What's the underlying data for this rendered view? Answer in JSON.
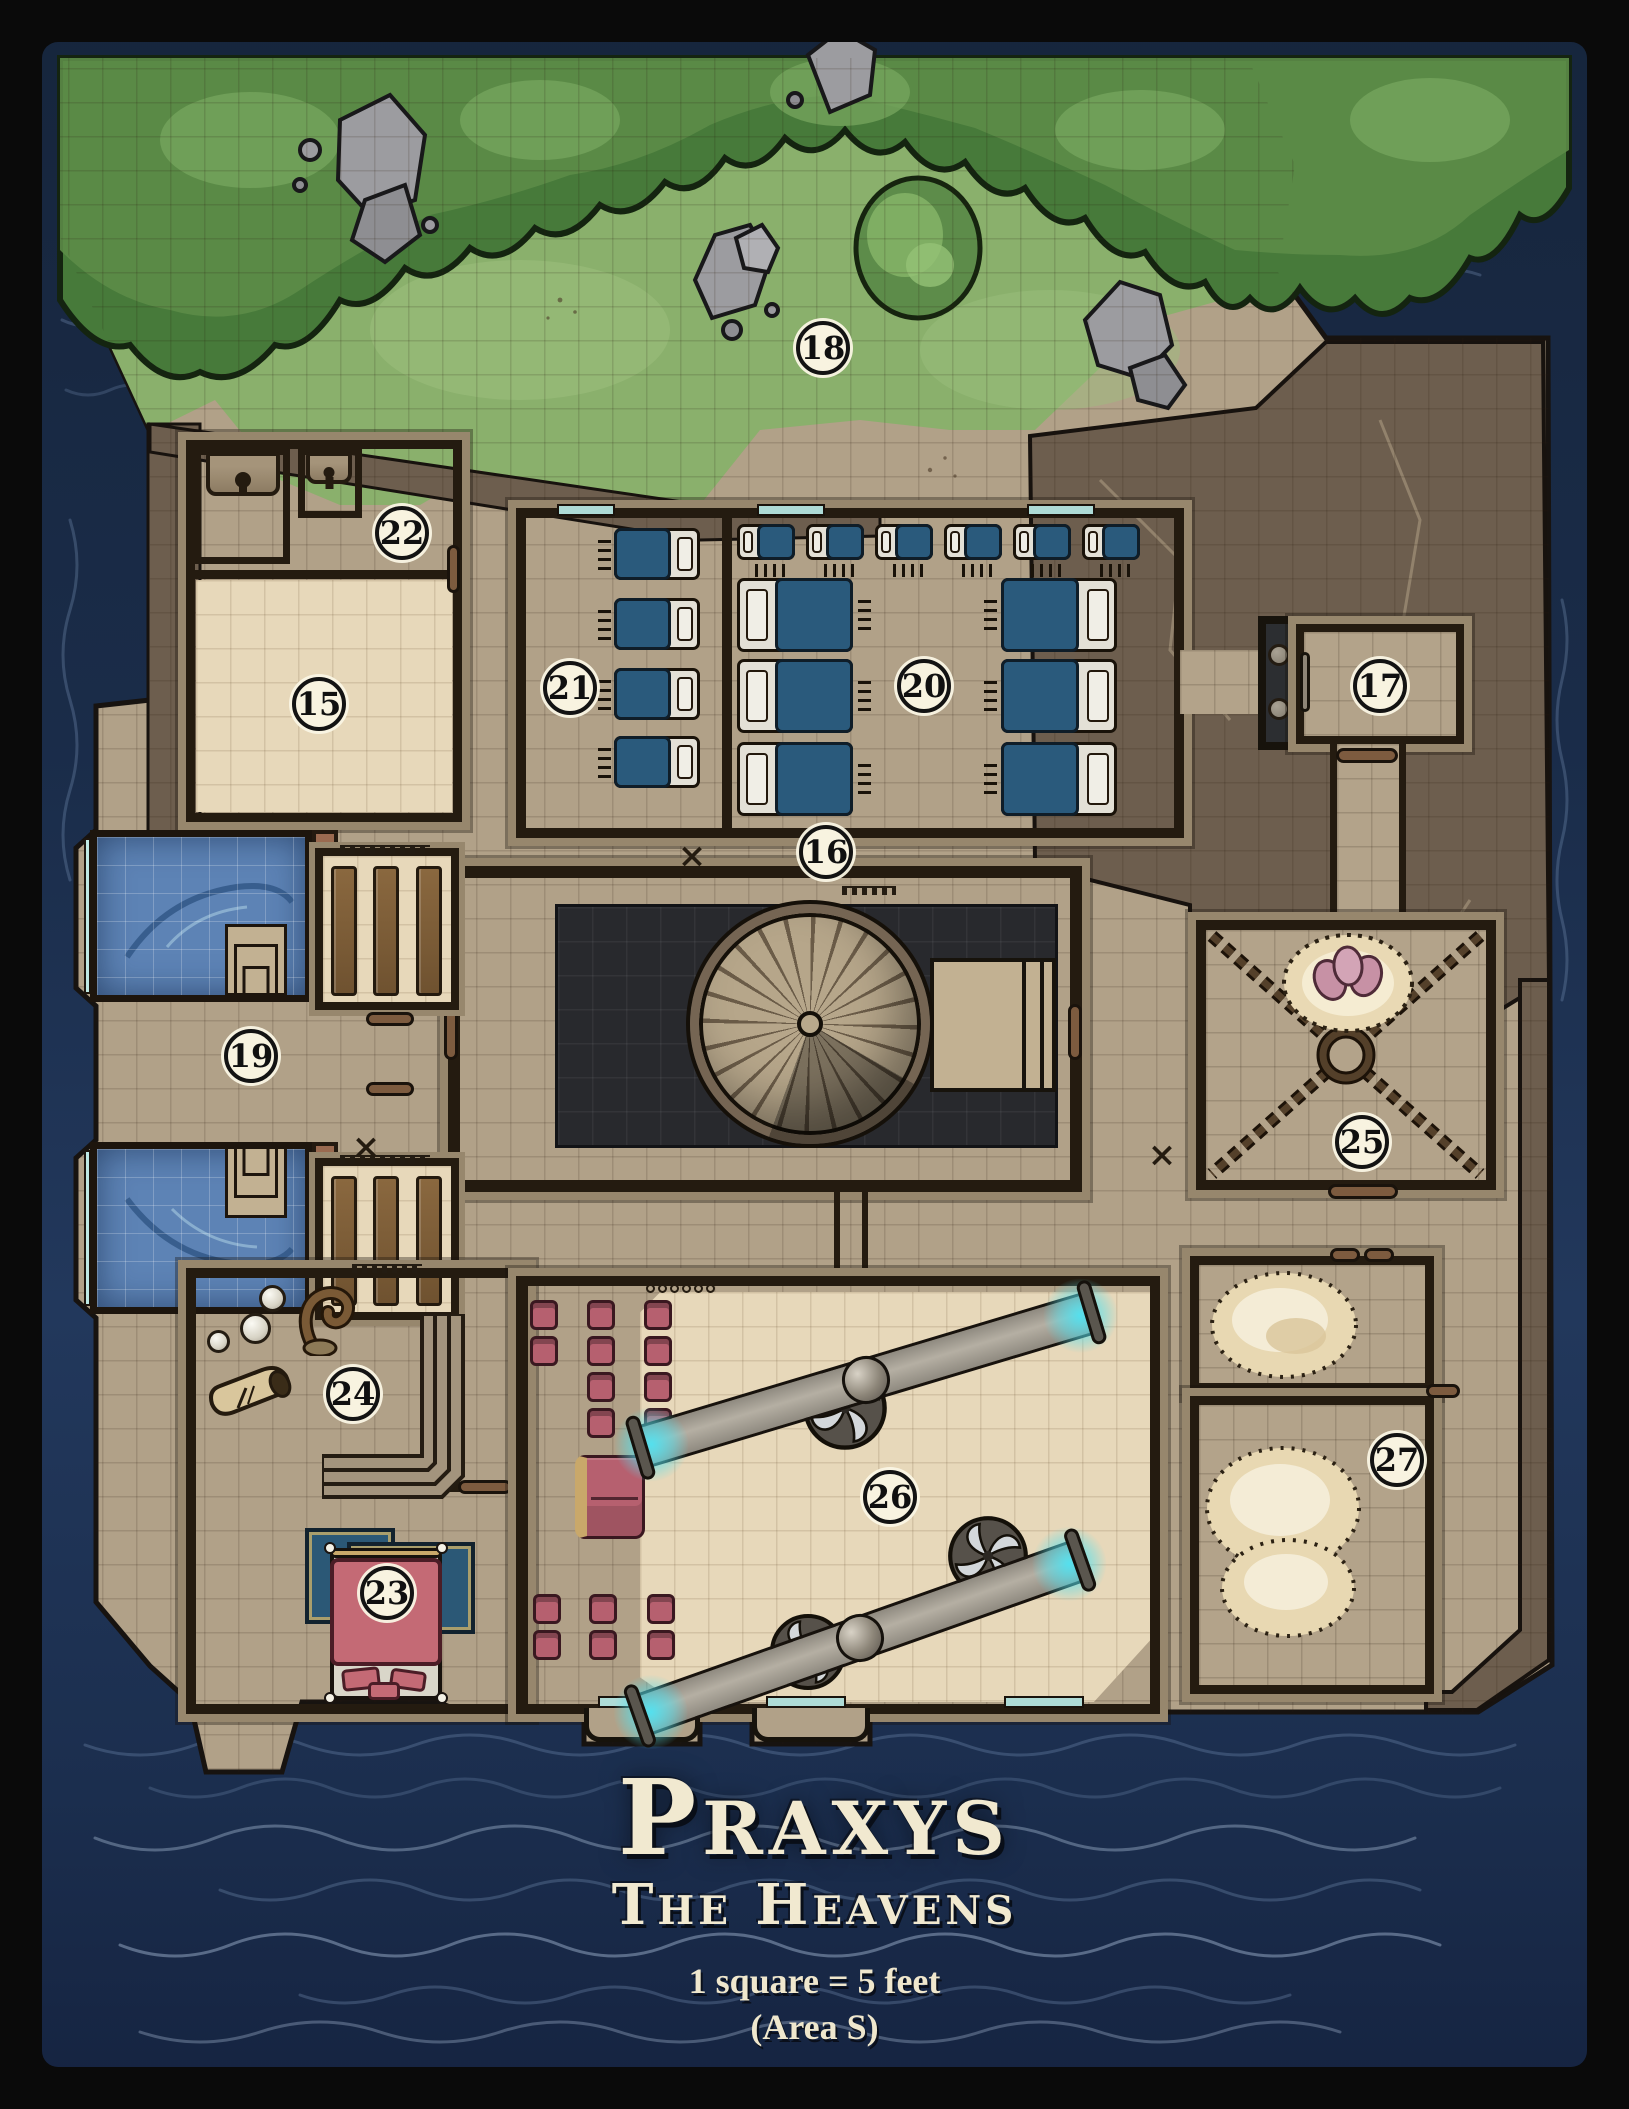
{
  "map": {
    "title": "Praxys",
    "subtitle": "The Heavens",
    "scale_note": "1 square = 5 feet",
    "area_note": "(Area S)",
    "markers": {
      "x": "×"
    },
    "areas": [
      {
        "id": "15",
        "label": "15"
      },
      {
        "id": "16",
        "label": "16"
      },
      {
        "id": "17",
        "label": "17"
      },
      {
        "id": "18",
        "label": "18"
      },
      {
        "id": "19",
        "label": "19"
      },
      {
        "id": "20",
        "label": "20"
      },
      {
        "id": "21",
        "label": "21"
      },
      {
        "id": "22",
        "label": "22"
      },
      {
        "id": "23",
        "label": "23"
      },
      {
        "id": "24",
        "label": "24"
      },
      {
        "id": "25",
        "label": "25"
      },
      {
        "id": "26",
        "label": "26"
      },
      {
        "id": "27",
        "label": "27"
      }
    ],
    "colors": {
      "water": "#1a2c49",
      "land": "#b1a188",
      "grass": "#8ab06c",
      "canopy": "#4a7b3c",
      "crag": "#6d5e4e",
      "pool": "#5d83b5",
      "bed_blanket": "#2a5a7c",
      "chair": "#b6606f",
      "beam_glow": "#54e0ee",
      "title_text": "#f1e9d0"
    }
  }
}
